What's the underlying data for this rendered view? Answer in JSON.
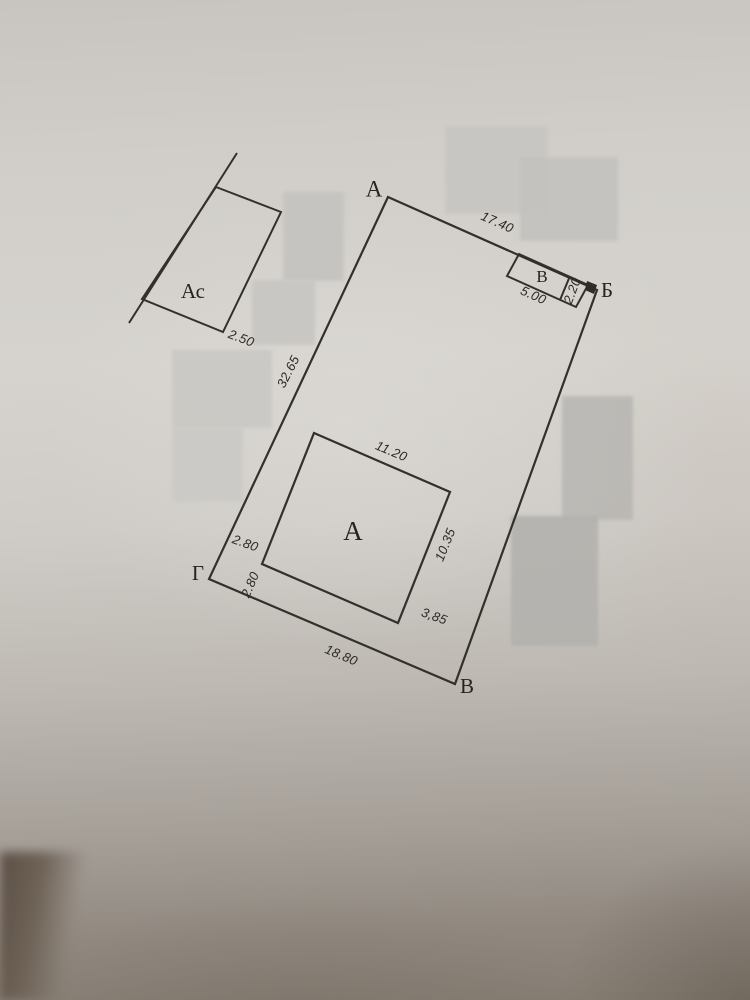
{
  "colors": {
    "ink": "#332f2a",
    "paper_light": "#d6d3ce",
    "paper_dark": "#857c72",
    "redaction_patch": "#c0bebA"
  },
  "plan": {
    "corners": {
      "a": "А",
      "b": "Б",
      "v": "В",
      "g": "Г"
    },
    "parcel_dims": {
      "top": "17.40",
      "left": "32.65",
      "bottom": "18.80"
    },
    "building": {
      "label": "А",
      "top": "11.20",
      "right": "10.35",
      "offset_bottom": "3,85",
      "offset_left_upper": "2.80",
      "offset_left_lower": "2.80"
    },
    "shed": {
      "label": "В",
      "width": "5.00",
      "depth": "2.20"
    },
    "annex": {
      "label": "Ас",
      "width": "2.50"
    }
  }
}
